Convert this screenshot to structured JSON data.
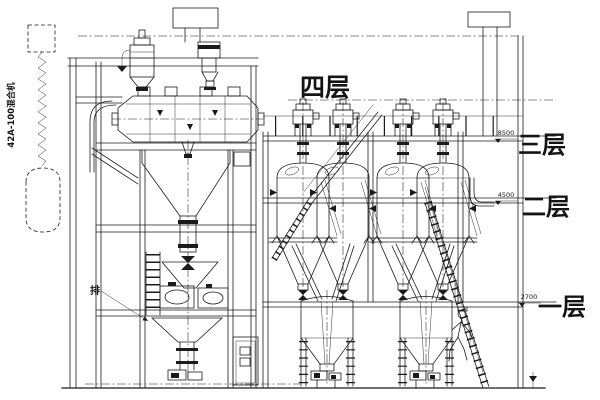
{
  "drawing": {
    "type": "engineering-elevation-drawing",
    "floor_labels": {
      "floor4": "四层",
      "floor3": "三层",
      "floor2": "二层",
      "floor1": "一层"
    },
    "elevations": {
      "floor3": "8500",
      "floor2": "4500",
      "floor1": "2700"
    },
    "annotations": {
      "left_equipment": "42A-100混合机",
      "discharge": "排"
    },
    "colors": {
      "line": "#1b1b1b",
      "background": "#ffffff"
    }
  }
}
